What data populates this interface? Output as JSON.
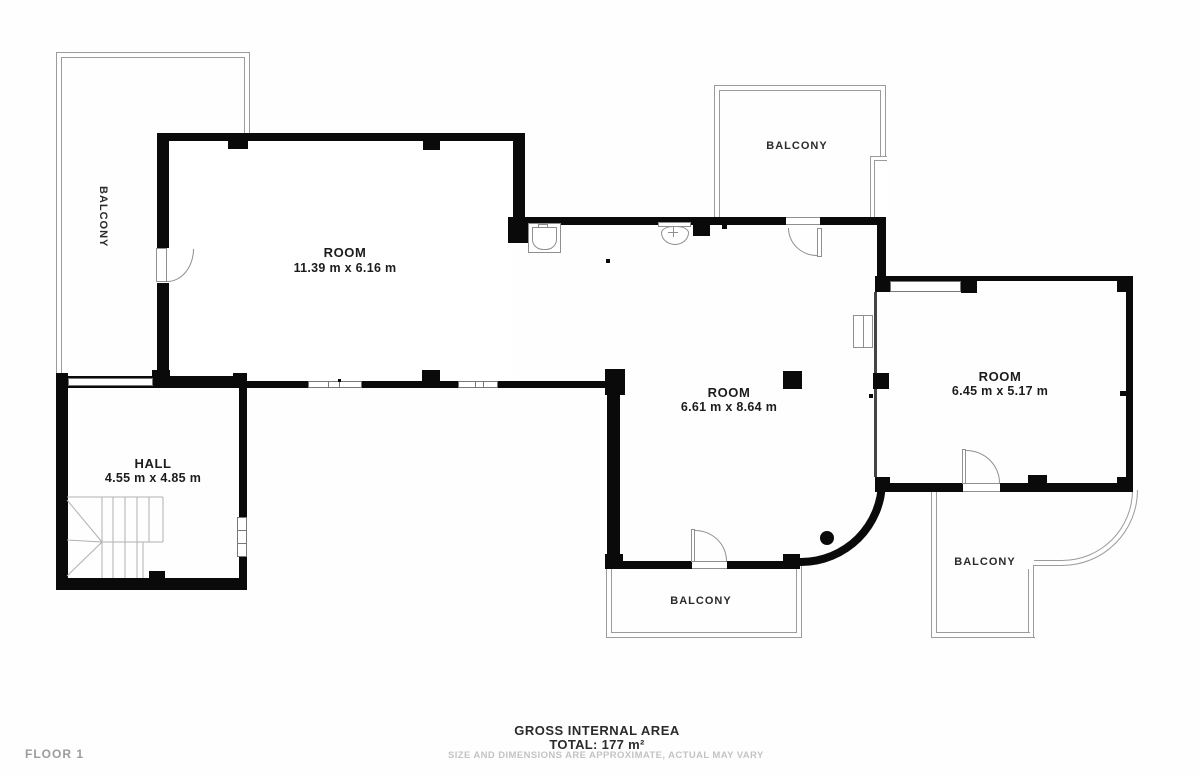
{
  "floor_plan": {
    "floor_label": "FLOOR 1",
    "rooms": [
      {
        "name": "ROOM",
        "dims": "11.39 m x 6.16 m"
      },
      {
        "name": "ROOM",
        "dims": "6.61 m x 8.64 m"
      },
      {
        "name": "ROOM",
        "dims": "6.45 m x 5.17 m"
      },
      {
        "name": "HALL",
        "dims": "4.55 m x 4.85 m"
      }
    ],
    "balconies": [
      {
        "label": "BALCONY"
      },
      {
        "label": "BALCONY"
      },
      {
        "label": "BALCONY"
      },
      {
        "label": "BALCONY"
      }
    ],
    "footer": {
      "title": "GROSS INTERNAL AREA",
      "total": "TOTAL: 177 m²",
      "disclaimer": "SIZE AND DIMENSIONS ARE APPROXIMATE, ACTUAL MAY VARY"
    },
    "colors": {
      "wall": "#0a0a0a",
      "balcony_outline": "#9b9b9b",
      "fixture_outline": "#8f8f8f",
      "stair_line": "#b0b0b0",
      "text_dark": "#1c1c1c",
      "text_muted": "#9c9c9c",
      "text_faint": "#c3c3c3"
    }
  }
}
